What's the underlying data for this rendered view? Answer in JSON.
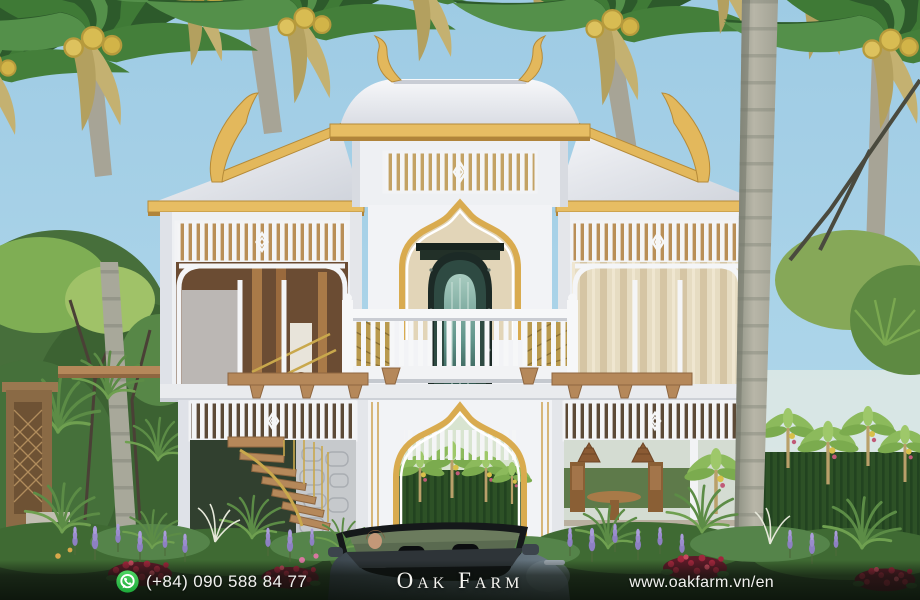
{
  "footer": {
    "phone": "(+84) 090 588 84 77",
    "brand": "Oak Farm",
    "website": "www.oakfarm.vn/en"
  },
  "scene": {
    "type": "architectural-render",
    "subject": "two-story white Thai-style villa with gold roof trim among palm trees",
    "elements": [
      "palm-canopy",
      "palm-trunk",
      "thai-roof",
      "attic-vent",
      "ornate-teal-portal",
      "balcony",
      "spiral-staircase",
      "garden-arch",
      "banana-grove",
      "convertible-car",
      "flower-bed",
      "carved-gate-post"
    ]
  },
  "palette": {
    "sky": "#a7d1e7",
    "roof_white": "#f2f3f6",
    "gold_trim": "#e3b85c",
    "facade": "#eef0f3",
    "foliage_dark": "#2f5b2d",
    "foliage_light": "#6fa050",
    "lavender": "#8d80c2",
    "crimson": "#a0263c",
    "portal_teal": "#2e5a50",
    "wood": "#b5885a",
    "car_body": "#4a565e",
    "whatsapp_green": "#2fbb4f",
    "footer_text": "#f2f2f0"
  }
}
